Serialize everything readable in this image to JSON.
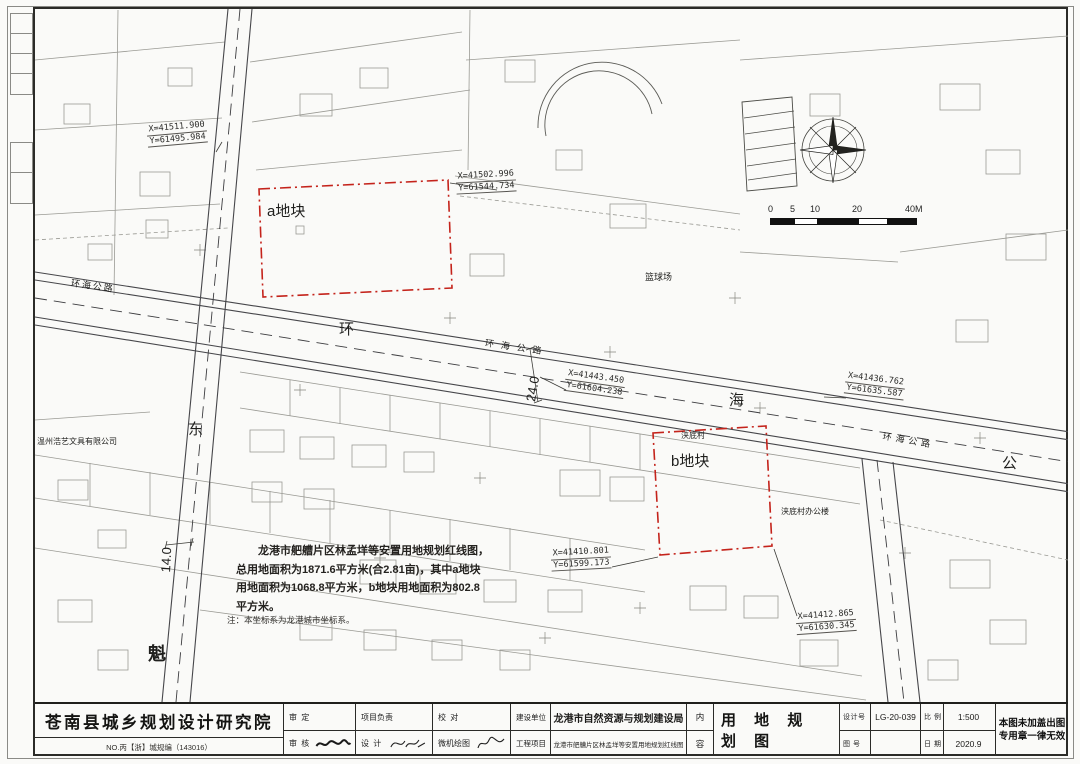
{
  "map": {
    "plot_a": "a地块",
    "plot_b": "b地块",
    "big_chars": {
      "huan": "环",
      "hai": "海",
      "gong": "公",
      "dong": "东",
      "kui": "魁"
    },
    "road_small": "环海公路",
    "widths": {
      "main": "24.0",
      "side": "14.0"
    },
    "labels": {
      "basketball": "篮球场",
      "village": "浃底村",
      "village_office": "浃底村办公楼",
      "company": "温州浩艺文具有限公司"
    },
    "coordinates": [
      {
        "x": "X=41511.900",
        "y": "Y=61495.984"
      },
      {
        "x": "X=41502.996",
        "y": "Y=61544.734"
      },
      {
        "x": "X=41443.450",
        "y": "Y=61604.238"
      },
      {
        "x": "X=41436.762",
        "y": "Y=61635.587"
      },
      {
        "x": "X=41410.801",
        "y": "Y=61599.173"
      },
      {
        "x": "X=41412.865",
        "y": "Y=61630.345"
      }
    ],
    "note": {
      "l1": "龙港市舥艚片区林孟垟等安置用地规划红线图，",
      "l2": "总用地面积为1871.6平方米(合2.81亩)，其中a地块",
      "l3": "用地面积为1068.8平方米，b地块用地面积为802.8",
      "l4": "平方米。",
      "foot": "注：本坐标系为龙港城市坐标系。"
    },
    "scale": {
      "t0": "0",
      "t1": "5",
      "t2": "10",
      "t3": "20",
      "t4": "40M"
    }
  },
  "title_block": {
    "institute": "苍南县城乡规划设计研究院",
    "license": "NO.丙【浙】城规编（143016）",
    "approve_label": "审 定",
    "review_label": "审 核",
    "project_lead_label": "项目负责",
    "design_label": "设 计",
    "proof_label": "校 对",
    "cad_label": "微机绘图",
    "client_label": "建设单位",
    "client_value": "龙港市自然资源与规划建设局",
    "project_label": "工程项目",
    "project_value": "龙港市舥艚片区林孟垟等安置用地规划红线图",
    "content_top": "内",
    "content_bottom": "容",
    "drawing_title": "用 地 规 划 图",
    "design_no_label": "设计号",
    "design_no_value": "LG-20-039",
    "sheet_no_label": "图 号",
    "sheet_no_value": "",
    "scale_label": "比 例",
    "scale_value": "1:500",
    "date_label": "日 期",
    "date_value": "2020.9",
    "seal_note_line1": "本图未加盖出图",
    "seal_note_line2": "专用章一律无效"
  }
}
